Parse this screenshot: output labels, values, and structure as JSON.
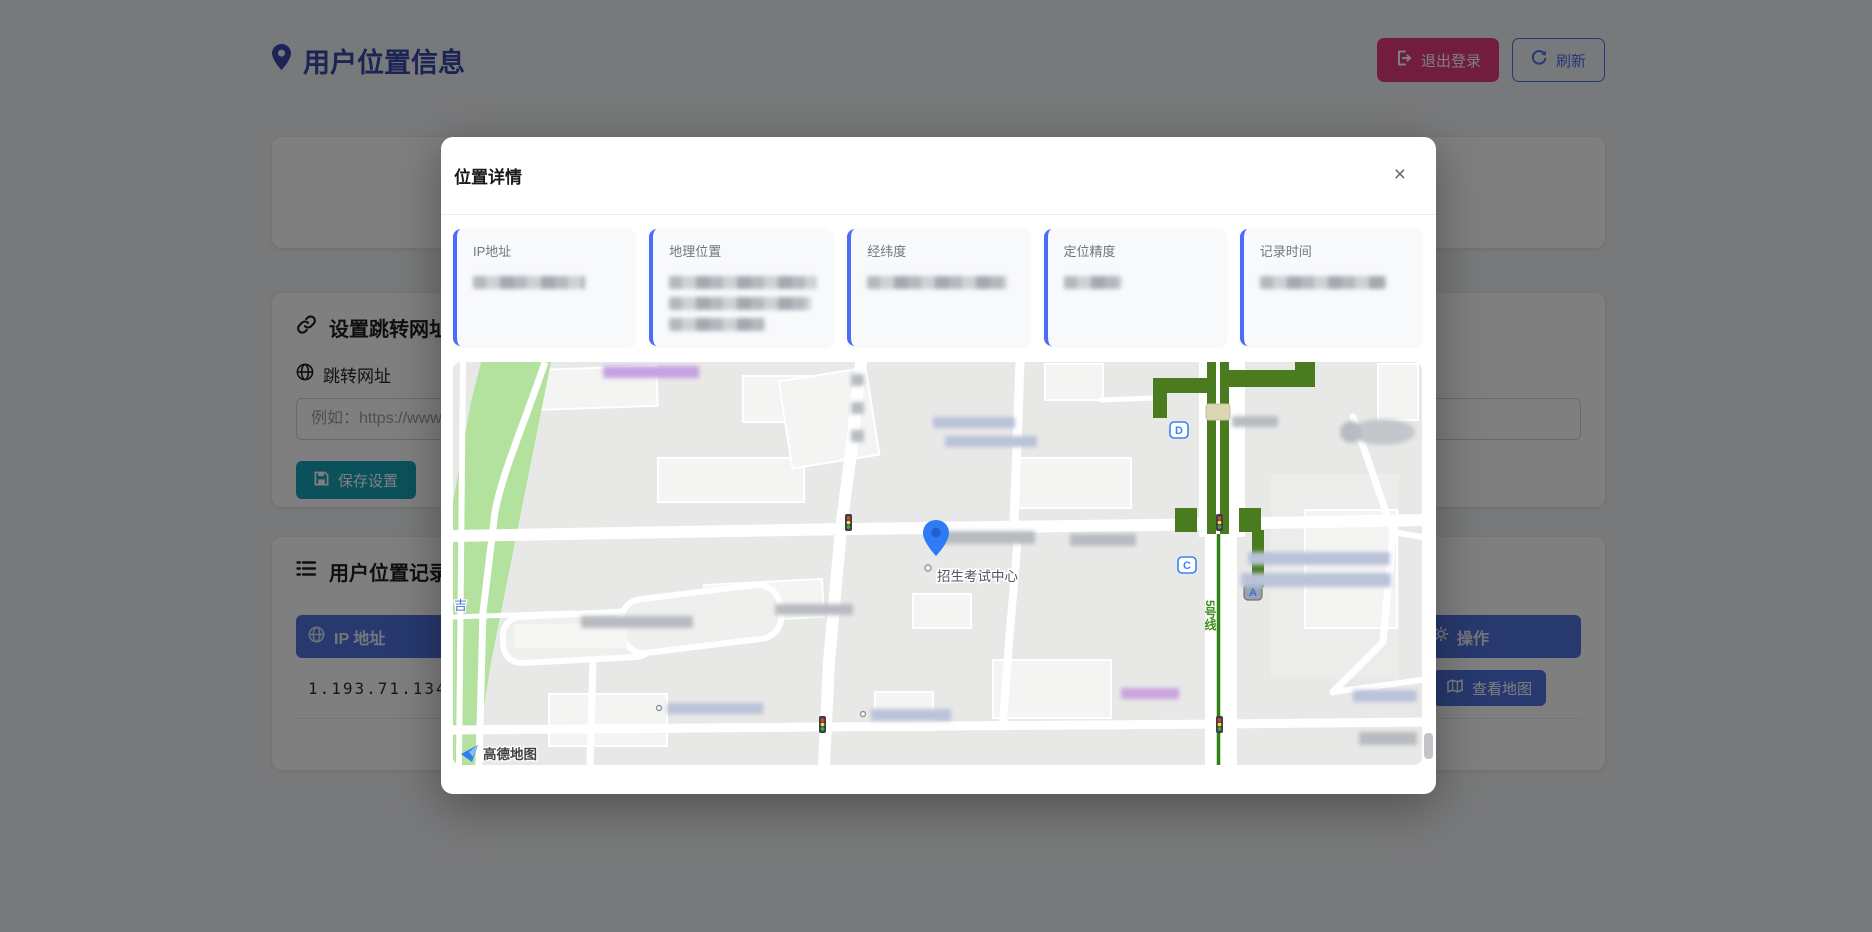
{
  "header": {
    "title": "用户位置信息",
    "logout": "退出登录",
    "refresh": "刷新"
  },
  "settings": {
    "title": "设置跳转网址",
    "field_label": "跳转网址",
    "placeholder": "例如：https://www.",
    "save": "保存设置"
  },
  "records": {
    "title": "用户位置记录",
    "col_ip": "IP 地址",
    "col_action": "操作",
    "ip_value": "1.193.71.134",
    "view_map": "查看地图"
  },
  "modal": {
    "title": "位置详情",
    "close": "×",
    "cards": [
      {
        "label": "IP地址",
        "redacted": true
      },
      {
        "label": "地理位置",
        "redacted": true
      },
      {
        "label": "经纬度",
        "redacted": true
      },
      {
        "label": "定位精度",
        "redacted": true
      },
      {
        "label": "记录时间",
        "redacted": true
      }
    ],
    "map": {
      "poi": "招生考试中心",
      "metro": "5号线",
      "exit_d": "D",
      "exit_c": "C",
      "exit_a": "A",
      "road_char": "吉",
      "logo": "高德地图"
    }
  },
  "colors": {
    "accent_blue": "#4e73df",
    "pink": "#e5397f",
    "teal": "#17a2b8",
    "title_indigo": "#3949ab",
    "card_border": "#4a6cf7",
    "elevated_road_green": "#4a7c1f",
    "park_green": "#b3e19e",
    "pin_blue": "#2f7bf5"
  }
}
